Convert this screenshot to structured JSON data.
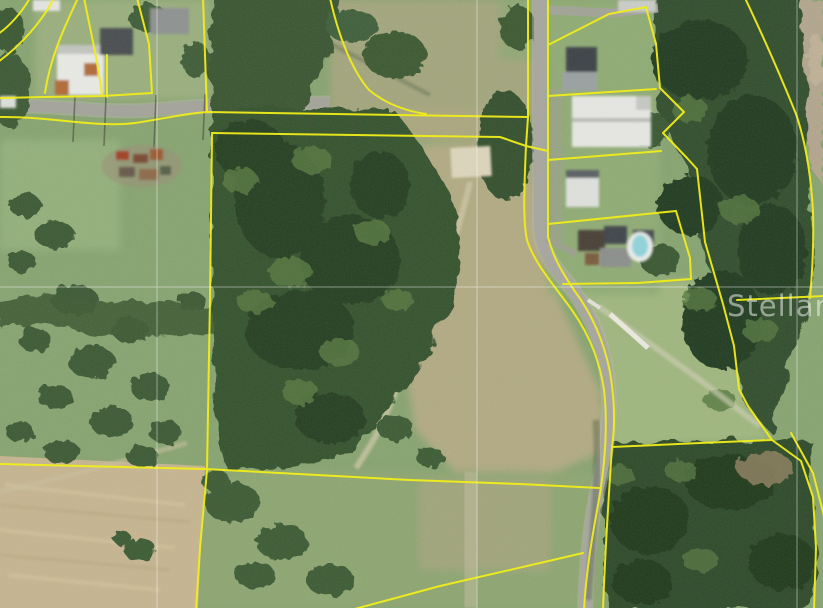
{
  "map": {
    "watermark": "Stellar MLS",
    "type": "aerial-parcel-map",
    "parcel_line_color": "#f4f011",
    "gridline_color": "#ffffff",
    "gridlines": {
      "vertical_x": [
        157,
        477,
        797
      ],
      "horizontal_y": [
        287
      ]
    }
  }
}
